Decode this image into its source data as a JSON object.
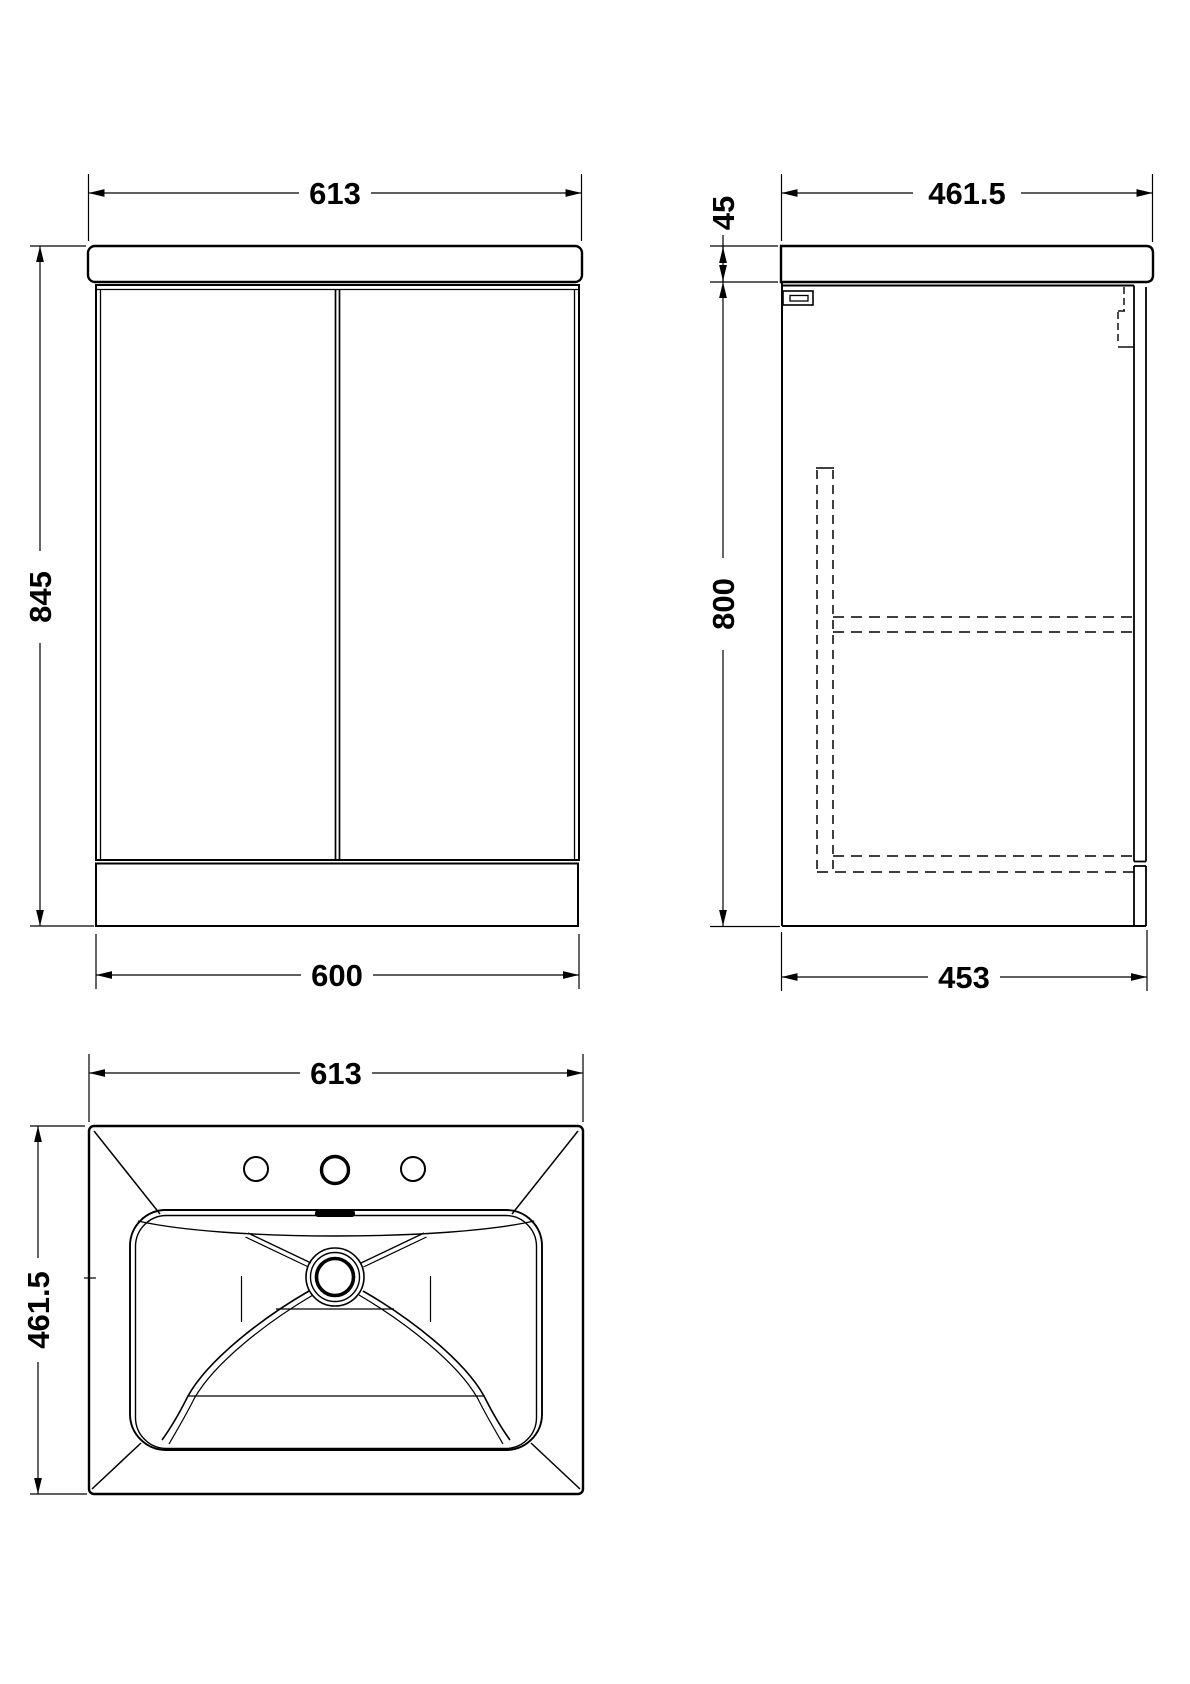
{
  "drawing": {
    "background_color": "#ffffff",
    "line_color": "#000000",
    "views": {
      "front": {
        "dim_width_top": "613",
        "dim_height": "845",
        "dim_width_bottom": "600"
      },
      "side": {
        "dim_depth_top": "461.5",
        "dim_counter_thickness": "45",
        "dim_body_height": "800",
        "dim_depth_bottom": "453"
      },
      "top": {
        "dim_width": "613",
        "dim_depth": "461.5"
      }
    }
  }
}
